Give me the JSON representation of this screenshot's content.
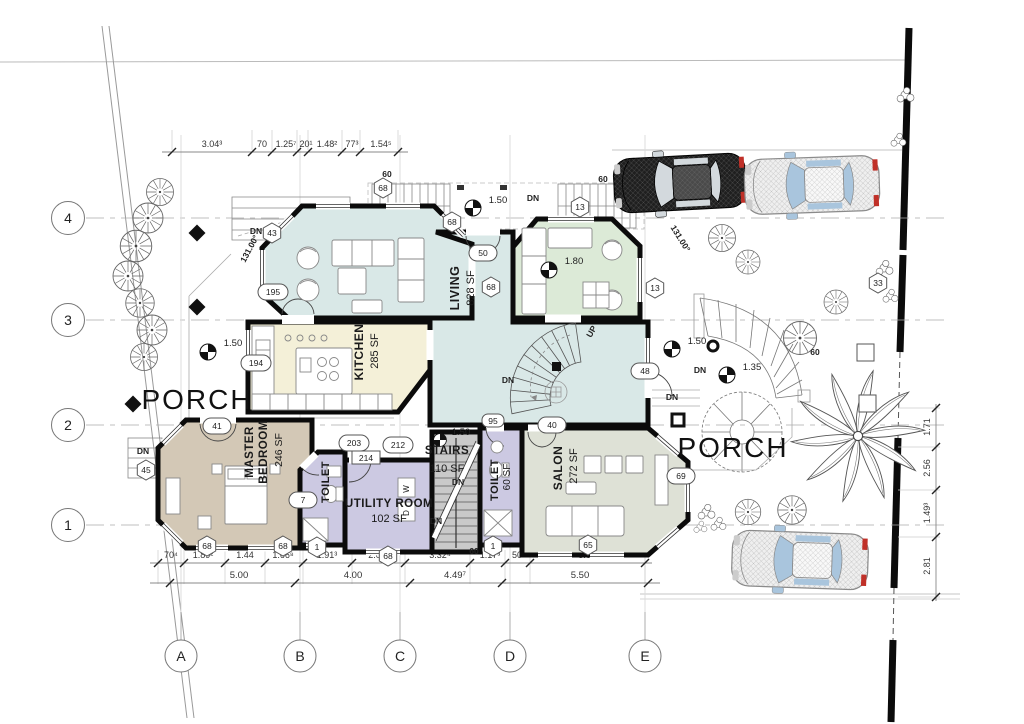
{
  "drawing": {
    "grid": {
      "rows": [
        "4",
        "3",
        "2",
        "1"
      ],
      "cols": [
        "A",
        "B",
        "C",
        "D",
        "E"
      ]
    },
    "dims": {
      "top": [
        "3.04³",
        "70",
        "1.25⁷",
        "20¹",
        "1.48²",
        "77³",
        "1.54⁵"
      ],
      "bottom_upper": [
        "70⁴",
        "1.89²",
        "1.44",
        "1.66⁸",
        "1.91³",
        "2.08",
        "3.32⁴",
        "1.17³",
        "50",
        "5.05"
      ],
      "bottom_lower": [
        "5.00",
        "4.00",
        "4.49⁷",
        "5.50"
      ],
      "right": [
        "1.71",
        "2.56",
        "1.49³",
        "2.81"
      ]
    },
    "rooms": {
      "living": {
        "name": "LIVING",
        "area": "828 SF"
      },
      "kitchen": {
        "name": "KITCHEN",
        "area": "285 SF"
      },
      "master": {
        "name1": "MASTER",
        "name2": "BEDROOM",
        "area": "246 SF"
      },
      "toilet1": {
        "name": "TOILET"
      },
      "utility": {
        "name": "UTILITY ROOM",
        "area": "102 SF"
      },
      "stairs": {
        "name": "STAIRS",
        "area": "110 SF"
      },
      "toilet2": {
        "name": "TOILET",
        "area": "60 SF"
      },
      "salon": {
        "name": "SALON",
        "area": "272 SF"
      }
    },
    "porch_left": "PORCH",
    "porch_right": "PORCH",
    "labels": {
      "dn": "DN",
      "up": "UP",
      "angle": "131.00°",
      "sixty": "60",
      "washer": "W",
      "dryer": "D"
    },
    "elevations": {
      "e150": "1.50",
      "e180": "1.80",
      "e135": "1.35"
    },
    "tags": {
      "o195": "195",
      "o194": "194",
      "o41": "41",
      "o203": "203",
      "o212": "212",
      "r214": "214",
      "o7": "7",
      "o40": "40",
      "o48": "48",
      "o69": "69",
      "o50": "50",
      "o95": "95",
      "h68": "68",
      "h43": "43",
      "h45": "45",
      "h13": "13",
      "h1": "1",
      "h65": "65",
      "h33": "33"
    },
    "colors": {
      "living": "#d9e8e7",
      "green": "#dcead7",
      "kitchen": "#f4f0d8",
      "master": "#d3c8b6",
      "wet": "#ccc9e2",
      "stairs": "#c9c9c9",
      "salon": "#dee1d6",
      "wall": "#0b0b0b",
      "car_dark_body": "#1f1f1f",
      "car_dark_roof": "#4a4a4a",
      "car_light_body": "#efefef",
      "car_light_roof": "#f8f8f8",
      "glass": "#a9c5dd",
      "glass_dark": "#d3d9dd",
      "tail": "#c03028",
      "car_stroke_dark": "#000000",
      "car_stroke_light": "#8a8a8a"
    }
  }
}
